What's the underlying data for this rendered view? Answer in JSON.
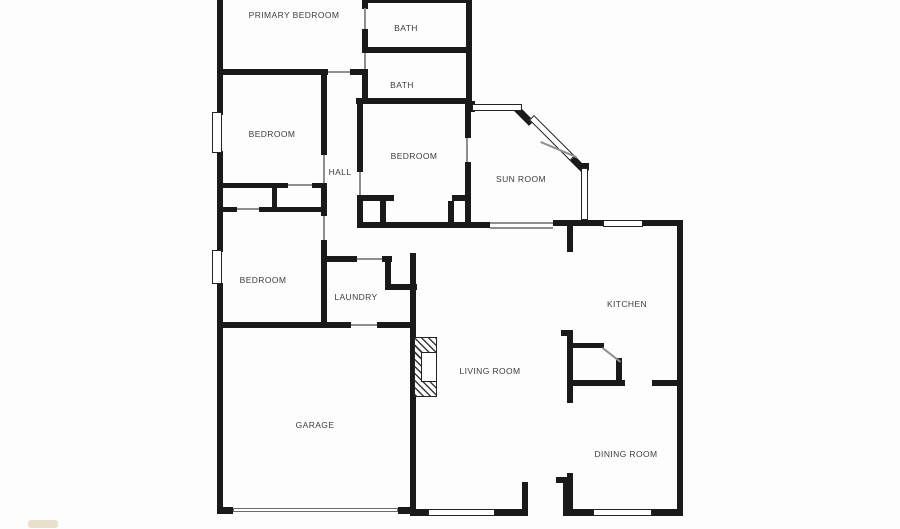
{
  "plan": {
    "title": "Floor plan",
    "width": 900,
    "height": 529,
    "background_color": "#fdfdfd",
    "wall_color": "#1a1a1a",
    "label_color": "#3d3d3d"
  },
  "rooms": [
    {
      "id": "primary-bedroom",
      "label": "PRIMARY BEDROOM",
      "x": 294,
      "y": 15
    },
    {
      "id": "bath-1",
      "label": "BATH",
      "x": 406,
      "y": 28
    },
    {
      "id": "bath-2",
      "label": "BATH",
      "x": 402,
      "y": 85
    },
    {
      "id": "bedroom-1",
      "label": "BEDROOM",
      "x": 272,
      "y": 134
    },
    {
      "id": "bedroom-2",
      "label": "BEDROOM",
      "x": 414,
      "y": 156
    },
    {
      "id": "hall",
      "label": "HALL",
      "x": 340,
      "y": 172
    },
    {
      "id": "sun-room",
      "label": "SUN ROOM",
      "x": 521,
      "y": 179
    },
    {
      "id": "bedroom-3",
      "label": "BEDROOM",
      "x": 263,
      "y": 280
    },
    {
      "id": "laundry",
      "label": "LAUNDRY",
      "x": 356,
      "y": 297
    },
    {
      "id": "kitchen",
      "label": "KITCHEN",
      "x": 627,
      "y": 304
    },
    {
      "id": "living-room",
      "label": "LIVING ROOM",
      "x": 490,
      "y": 371
    },
    {
      "id": "garage",
      "label": "GARAGE",
      "x": 315,
      "y": 425
    },
    {
      "id": "dining-room",
      "label": "DINING ROOM",
      "x": 626,
      "y": 454
    }
  ],
  "walls": [
    {
      "x": 217,
      "y": 0,
      "w": 6,
      "h": 115
    },
    {
      "x": 217,
      "y": 151,
      "w": 6,
      "h": 101
    },
    {
      "x": 217,
      "y": 283,
      "w": 6,
      "h": 231
    },
    {
      "x": 368,
      "y": 0,
      "w": 100,
      "h": 3
    },
    {
      "x": 217,
      "y": 69,
      "w": 111,
      "h": 6
    },
    {
      "x": 350,
      "y": 69,
      "w": 13,
      "h": 6
    },
    {
      "x": 362,
      "y": 0,
      "w": 6,
      "h": 9
    },
    {
      "x": 362,
      "y": 29,
      "w": 6,
      "h": 24
    },
    {
      "x": 362,
      "y": 69,
      "w": 6,
      "h": 32
    },
    {
      "x": 366,
      "y": 47,
      "w": 101,
      "h": 6
    },
    {
      "x": 466,
      "y": 0,
      "w": 6,
      "h": 104
    },
    {
      "x": 356,
      "y": 98,
      "w": 114,
      "h": 6
    },
    {
      "x": 357,
      "y": 104,
      "w": 6,
      "h": 68
    },
    {
      "x": 357,
      "y": 195,
      "w": 6,
      "h": 33
    },
    {
      "x": 357,
      "y": 195,
      "w": 37,
      "h": 6
    },
    {
      "x": 380,
      "y": 201,
      "w": 6,
      "h": 24
    },
    {
      "x": 452,
      "y": 195,
      "w": 16,
      "h": 6
    },
    {
      "x": 448,
      "y": 201,
      "w": 6,
      "h": 22
    },
    {
      "x": 321,
      "y": 74,
      "w": 6,
      "h": 81
    },
    {
      "x": 220,
      "y": 183,
      "w": 68,
      "h": 5
    },
    {
      "x": 312,
      "y": 183,
      "w": 15,
      "h": 5
    },
    {
      "x": 272,
      "y": 188,
      "w": 5,
      "h": 21
    },
    {
      "x": 220,
      "y": 207,
      "w": 17,
      "h": 5
    },
    {
      "x": 259,
      "y": 207,
      "w": 68,
      "h": 5
    },
    {
      "x": 321,
      "y": 183,
      "w": 6,
      "h": 33
    },
    {
      "x": 321,
      "y": 240,
      "w": 6,
      "h": 88
    },
    {
      "x": 217,
      "y": 322,
      "w": 134,
      "h": 6
    },
    {
      "x": 377,
      "y": 322,
      "w": 39,
      "h": 6
    },
    {
      "x": 325,
      "y": 256,
      "w": 32,
      "h": 6
    },
    {
      "x": 382,
      "y": 256,
      "w": 10,
      "h": 6
    },
    {
      "x": 385,
      "y": 262,
      "w": 6,
      "h": 26
    },
    {
      "x": 385,
      "y": 284,
      "w": 32,
      "h": 6
    },
    {
      "x": 410,
      "y": 253,
      "w": 6,
      "h": 262
    },
    {
      "x": 465,
      "y": 104,
      "w": 6,
      "h": 34
    },
    {
      "x": 465,
      "y": 162,
      "w": 6,
      "h": 60
    },
    {
      "x": 357,
      "y": 222,
      "w": 133,
      "h": 6
    },
    {
      "x": 553,
      "y": 220,
      "w": 50,
      "h": 6
    },
    {
      "x": 643,
      "y": 220,
      "w": 40,
      "h": 6
    },
    {
      "x": 567,
      "y": 226,
      "w": 6,
      "h": 26
    },
    {
      "x": 677,
      "y": 220,
      "w": 6,
      "h": 295
    },
    {
      "x": 572,
      "y": 343,
      "w": 32,
      "h": 5
    },
    {
      "x": 616,
      "y": 358,
      "w": 6,
      "h": 26
    },
    {
      "x": 572,
      "y": 380,
      "w": 53,
      "h": 6
    },
    {
      "x": 652,
      "y": 380,
      "w": 25,
      "h": 6
    },
    {
      "x": 561,
      "y": 330,
      "w": 12,
      "h": 6
    },
    {
      "x": 567,
      "y": 330,
      "w": 6,
      "h": 73
    },
    {
      "x": 567,
      "y": 473,
      "w": 6,
      "h": 42
    },
    {
      "x": 556,
      "y": 477,
      "w": 12,
      "h": 6
    },
    {
      "x": 567,
      "y": 509,
      "w": 26,
      "h": 7
    },
    {
      "x": 652,
      "y": 509,
      "w": 31,
      "h": 7
    },
    {
      "x": 410,
      "y": 509,
      "w": 19,
      "h": 7
    },
    {
      "x": 495,
      "y": 509,
      "w": 27,
      "h": 7
    },
    {
      "x": 522,
      "y": 482,
      "w": 6,
      "h": 34
    },
    {
      "x": 563,
      "y": 482,
      "w": 6,
      "h": 34
    },
    {
      "x": 563,
      "y": 509,
      "w": 30,
      "h": 7
    },
    {
      "x": 217,
      "y": 507,
      "w": 16,
      "h": 7
    },
    {
      "x": 398,
      "y": 507,
      "w": 18,
      "h": 7
    },
    {
      "x": 468,
      "y": 101,
      "w": 7,
      "h": 11
    },
    {
      "x": 579,
      "y": 163,
      "w": 10,
      "h": 7
    },
    {
      "x": 517,
      "y": 104,
      "w": 24,
      "h": 7,
      "r": 45
    },
    {
      "x": 572,
      "y": 153,
      "w": 24,
      "h": 7,
      "r": 45
    }
  ],
  "windows": [
    {
      "x": 212,
      "y": 112,
      "w": 10,
      "h": 41
    },
    {
      "x": 212,
      "y": 250,
      "w": 10,
      "h": 34
    },
    {
      "x": 472,
      "y": 104,
      "w": 50,
      "h": 7
    },
    {
      "x": 534,
      "y": 115,
      "w": 58,
      "h": 7,
      "r": 45
    },
    {
      "x": 581,
      "y": 168,
      "w": 7,
      "h": 52
    },
    {
      "x": 603,
      "y": 220,
      "w": 40,
      "h": 7
    },
    {
      "x": 428,
      "y": 509,
      "w": 67,
      "h": 7
    },
    {
      "x": 593,
      "y": 509,
      "w": 59,
      "h": 7
    }
  ],
  "door_headers": [
    {
      "x": 328,
      "y": 71,
      "w": 22,
      "h": 2
    },
    {
      "x": 364,
      "y": 8,
      "w": 2,
      "h": 21
    },
    {
      "x": 364,
      "y": 53,
      "w": 2,
      "h": 16
    },
    {
      "x": 288,
      "y": 184,
      "w": 24,
      "h": 2
    },
    {
      "x": 237,
      "y": 208,
      "w": 22,
      "h": 2
    },
    {
      "x": 323,
      "y": 155,
      "w": 2,
      "h": 28
    },
    {
      "x": 323,
      "y": 216,
      "w": 2,
      "h": 24
    },
    {
      "x": 359,
      "y": 172,
      "w": 2,
      "h": 23
    },
    {
      "x": 466,
      "y": 138,
      "w": 2,
      "h": 24
    },
    {
      "x": 357,
      "y": 258,
      "w": 25,
      "h": 2
    },
    {
      "x": 351,
      "y": 324,
      "w": 26,
      "h": 2
    },
    {
      "x": 490,
      "y": 222,
      "w": 63,
      "h": 2
    },
    {
      "x": 490,
      "y": 227,
      "w": 63,
      "h": 2
    },
    {
      "x": 603,
      "y": 347,
      "w": 23,
      "h": 2,
      "r": 38
    },
    {
      "x": 541,
      "y": 141,
      "w": 39,
      "h": 2,
      "r": 23
    }
  ],
  "garage_door": {
    "x": 233,
    "y": 508,
    "w": 165,
    "h": 4
  },
  "fireplace": {
    "outer": {
      "x": 414,
      "y": 337,
      "w": 23,
      "h": 60
    },
    "firebox": {
      "x": 421,
      "y": 352,
      "w": 16,
      "h": 30
    }
  },
  "watermark": {
    "x": 28,
    "y": 520,
    "w": 30,
    "h": 8
  }
}
